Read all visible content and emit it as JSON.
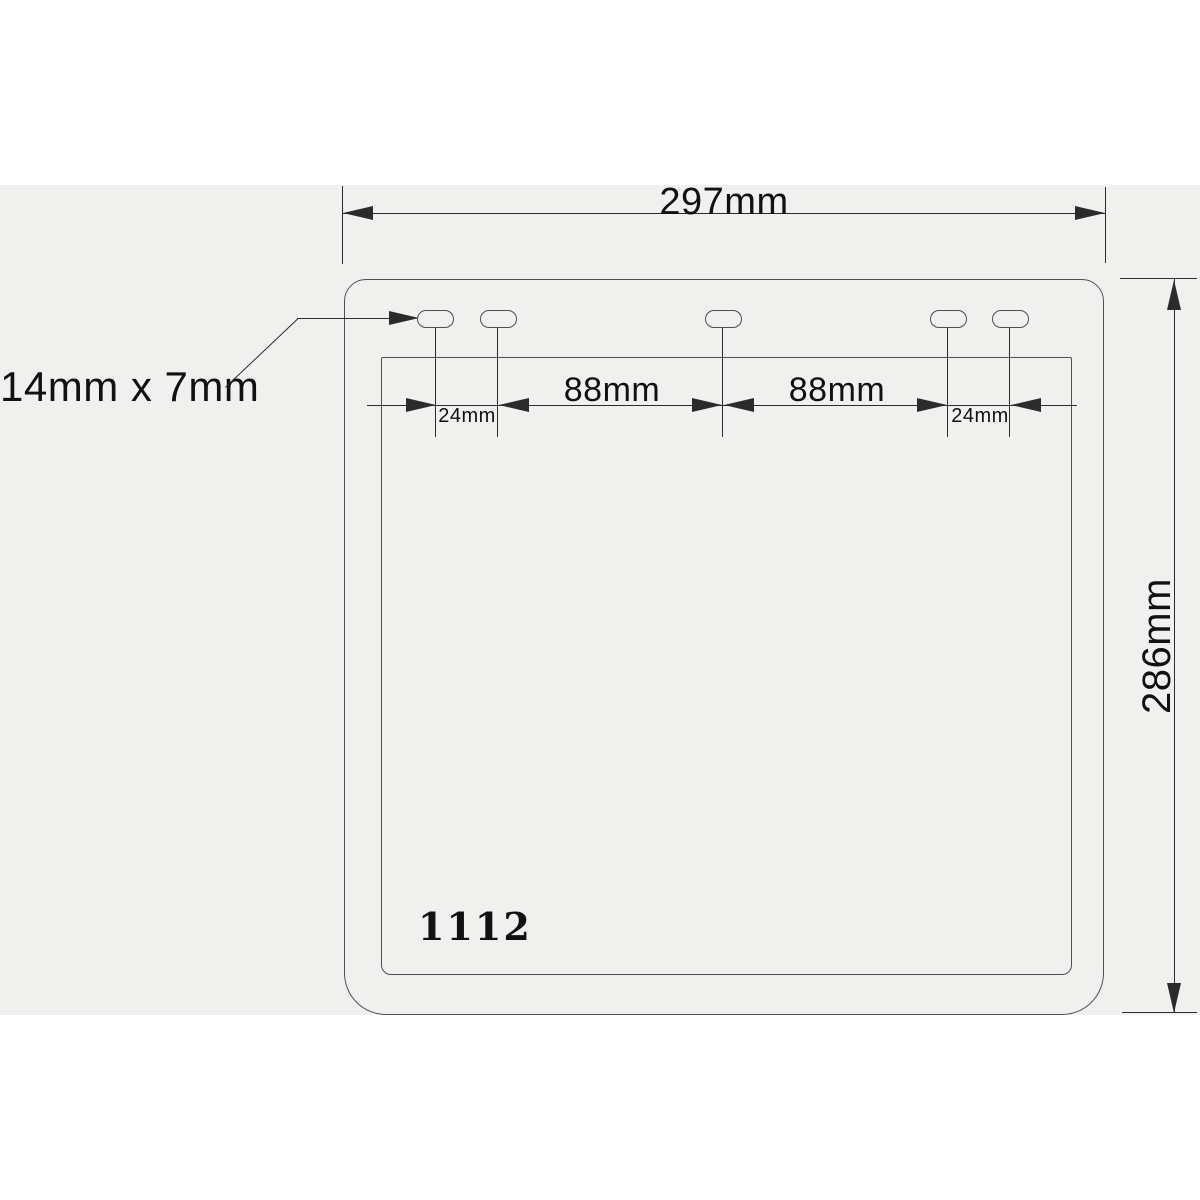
{
  "diagram": {
    "part_number": "1112",
    "labels": {
      "overall_width": "297mm",
      "overall_height": "286mm",
      "slot_size": "14mm x 7mm",
      "offset_left": "24mm",
      "span_left": "88mm",
      "span_right": "88mm",
      "offset_right": "24mm"
    },
    "slot_count": 5,
    "colors": {
      "background": "#ffffff",
      "panel_background": "#f0f0ef",
      "outline": "#4f4f4f",
      "dimension_line": "#2b2b2b",
      "text": "#111111"
    }
  }
}
